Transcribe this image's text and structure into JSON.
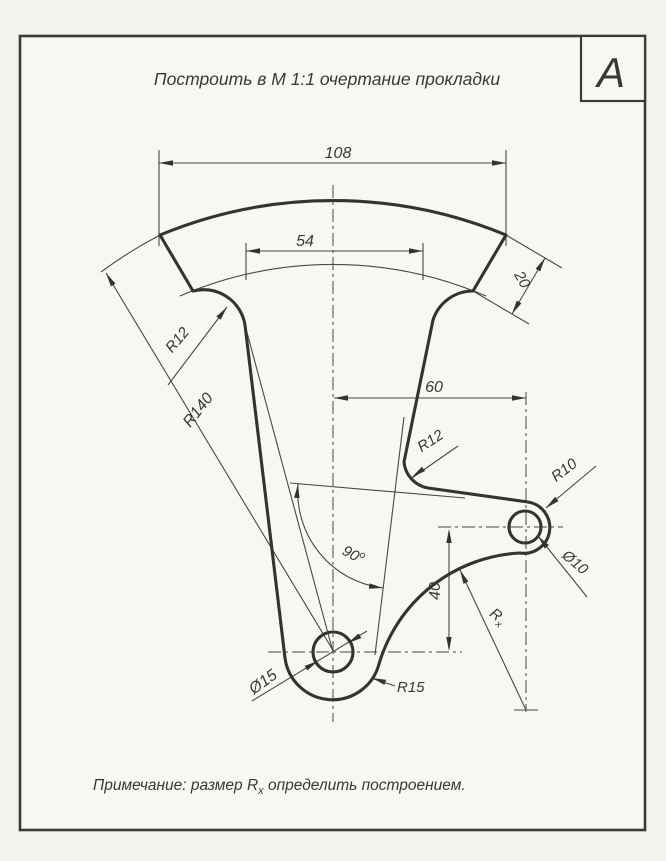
{
  "sheet": {
    "marker_letter": "А",
    "title": "Построить в М 1:1 очертание прокладки",
    "note_prefix": "Примечание: размер R",
    "note_sub": "x",
    "note_suffix": " определить построением."
  },
  "dims": {
    "outer_chord": "108",
    "inner_chord": "54",
    "ring_width": "20",
    "outer_radius": "R140",
    "left_fillet": "R12",
    "center_offset": "60",
    "right_fillet": "R12",
    "small_boss_radius": "R10",
    "small_hole": "Ø10",
    "angle_value": "90",
    "angle_sup": "o",
    "vertical_offset": "40",
    "unknown_radius_prefix": "R",
    "unknown_radius_sub": "x",
    "large_hole": "Ø15",
    "large_boss_radius": "R15"
  },
  "colors": {
    "thick_line": "#35332f",
    "thin_line": "#4a4742",
    "paper_outer": "#f3f2ee",
    "paper_inner": "#f8f7f3",
    "text": "#3a3834"
  }
}
